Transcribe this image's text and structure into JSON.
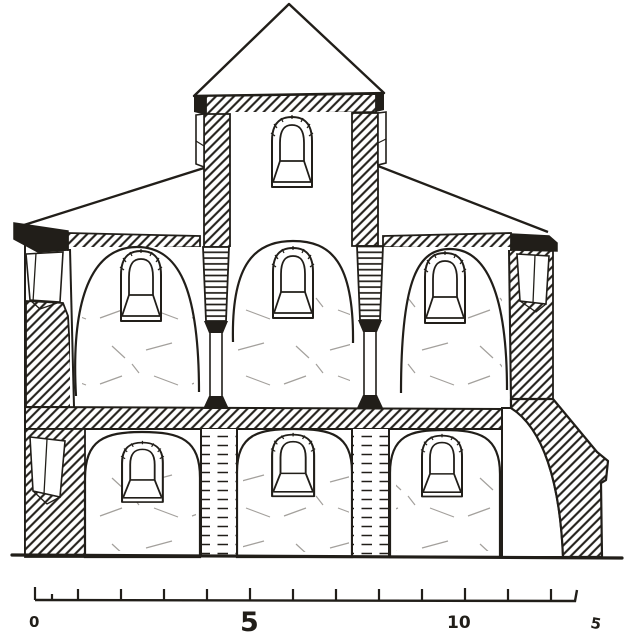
{
  "colors": {
    "ink": "#211e19",
    "paper": "#ffffff"
  },
  "scale_bar": {
    "unit_labels": [
      "0",
      "5",
      "10",
      "5"
    ]
  }
}
